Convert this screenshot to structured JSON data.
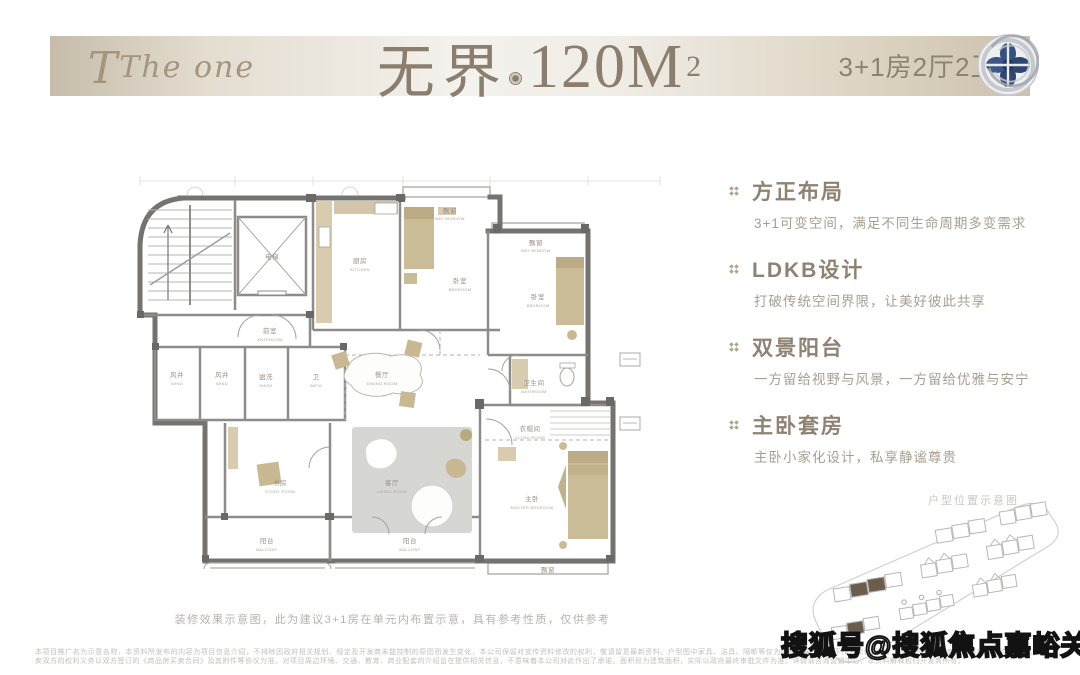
{
  "header": {
    "brand": "The one",
    "title_cn": "无界",
    "title_num": "120M",
    "title_sup": "2",
    "spec": "3+1房2厅2卫",
    "logo": "rose-flower-logo"
  },
  "features": [
    {
      "icon": "quad-diamond-icon",
      "title": "方正布局",
      "desc": "3+1可变空间，满足不同生命周期多变需求"
    },
    {
      "icon": "quad-diamond-icon",
      "title": "LDKB设计",
      "desc": "打破传统空间界限，让美好彼此共享"
    },
    {
      "icon": "quad-diamond-icon",
      "title": "双景阳台",
      "desc": "一方留给视野与风景，一方留给优雅与安宁"
    },
    {
      "icon": "quad-diamond-icon",
      "title": "主卧套房",
      "desc": "主卧小家化设计，私享静谧尊贵"
    }
  ],
  "floorplan": {
    "caption": "装修效果示意图，此为建议3+1房在单元内布置示意，具有参考性质，仅供参考",
    "rooms": {
      "elevator": {
        "cn": "电梯"
      },
      "anteroom": {
        "cn": "前室",
        "en": "ANTEROOM"
      },
      "wind1": {
        "cn": "风井",
        "en": "WIND"
      },
      "wind2": {
        "cn": "风井",
        "en": "WIND"
      },
      "wash": {
        "cn": "盥洗",
        "en": "WASH"
      },
      "bath2": {
        "cn": "卫",
        "en": "BATH"
      },
      "kitchen": {
        "cn": "厨房",
        "en": "KITCHEN"
      },
      "bedroom1": {
        "cn": "卧室",
        "en": "BEDROOM"
      },
      "bay1": {
        "cn": "飘窗",
        "en": "BAY WINDOW"
      },
      "bedroom2": {
        "cn": "卧室",
        "en": "BEDROOM"
      },
      "bay2": {
        "cn": "飘窗",
        "en": "BAY WINDOW"
      },
      "bathroom": {
        "cn": "卫生间",
        "en": "BATHROOM"
      },
      "dining": {
        "cn": "餐厅",
        "en": "DINING ROOM"
      },
      "living": {
        "cn": "客厅",
        "en": "LIVING ROOM"
      },
      "study": {
        "cn": "书房",
        "en": "STUDY ROOM"
      },
      "balcony1": {
        "cn": "阳台",
        "en": "BALCONY"
      },
      "balcony2": {
        "cn": "阳台",
        "en": "BALCONY"
      },
      "cloak": {
        "cn": "衣帽间",
        "en": "CLOAK ROOM"
      },
      "master": {
        "cn": "主卧",
        "en": "MASTER BEDROOM"
      },
      "bay3": {
        "cn": "飘窗",
        "en": "BAY WINDOW"
      }
    }
  },
  "siteplan": {
    "label": "户型位置示意图"
  },
  "watermark": "搜狐号@搜狐焦点嘉峪关站",
  "disclaimer": {
    "line1": "本项目推广名为示意名称，本资料所发布的内容为项目信息介绍，不排除因政府相关规划、规定及开发商未能控制的原因而发生变化，本公司保留对宣传资料修改的权利，敬请留意最新资料。户型图中家具、洁具、隔断等仅为装修效果示意，不作为交付标准，具体交付标准以商品房买卖合同约定为准。",
    "line2": "买卖双方的权利义务以双方签订的《商品房买卖合同》及其附件等协议为准。对项目周边环境、交通、教育、商业配套的介绍旨在提供相关信息，不意味着本公司对此作出了承诺。面积段为建筑面积，实际以政府最终审批文件为准。详情请咨询营销中心，本资料解释权归开发商所有。"
  },
  "colors": {
    "accent_tan": "#b3a488",
    "title_taupe": "#8b7e6e",
    "band_beige": "#d3c9b7",
    "logo_blue": "#34517f",
    "highlight_building": "#6b5d4d"
  }
}
